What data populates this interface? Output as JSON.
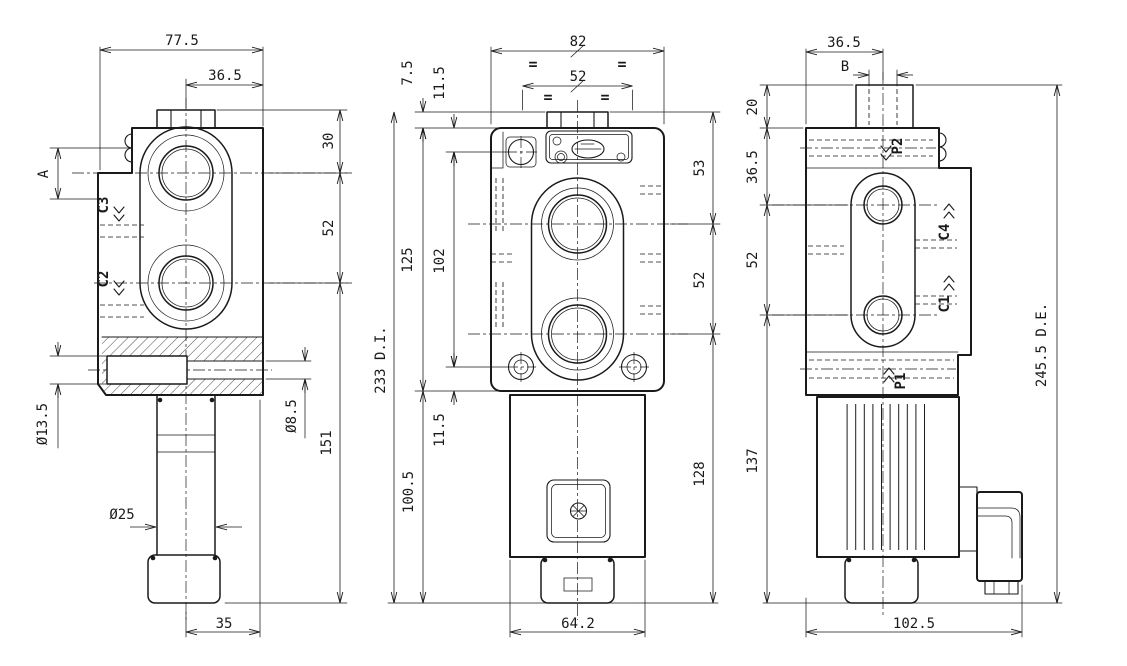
{
  "drawing": {
    "type": "hydraulic-valve-orthographic-views",
    "colors": {
      "line": "#1a1a1a",
      "background": "#ffffff"
    },
    "views": {
      "left": {
        "dims": {
          "overall_width": "77.5",
          "port_offset": "36.5",
          "thread_depth": "A",
          "top_to_port": "30",
          "port_spacing": "52",
          "port_to_bottom": "151",
          "bore_dia": "Ø13.5",
          "channel_dia": "Ø8.5",
          "stem_dia": "Ø25",
          "knob_width": "35"
        },
        "ports": {
          "c3": "C3",
          "c2": "C2"
        }
      },
      "front": {
        "dims": {
          "body_width": "82",
          "hole_spacing": "52",
          "hex_height": "7.5",
          "top_to_bolt": "11.5",
          "body_height": "125",
          "bolt_spacing": "102",
          "total_height": "233 D.I.",
          "bolt_to_bottom": "11.5",
          "body_to_bottom": "100.5",
          "top_to_port": "53",
          "port_spacing": "52",
          "port_to_bottom": "128",
          "solenoid_width": "64.2"
        },
        "symmetry_mark": "="
      },
      "right": {
        "dims": {
          "body_width_top": "36.5",
          "thread_size": "B",
          "fitting_height": "20",
          "top_to_port": "36.5",
          "port_spacing": "52",
          "port_to_bottom": "137",
          "total_height": "245.5 D.E.",
          "overall_width": "102.5"
        },
        "ports": {
          "p2": "P2",
          "c4": "C4",
          "c1": "C1",
          "p1": "P1"
        }
      }
    }
  }
}
